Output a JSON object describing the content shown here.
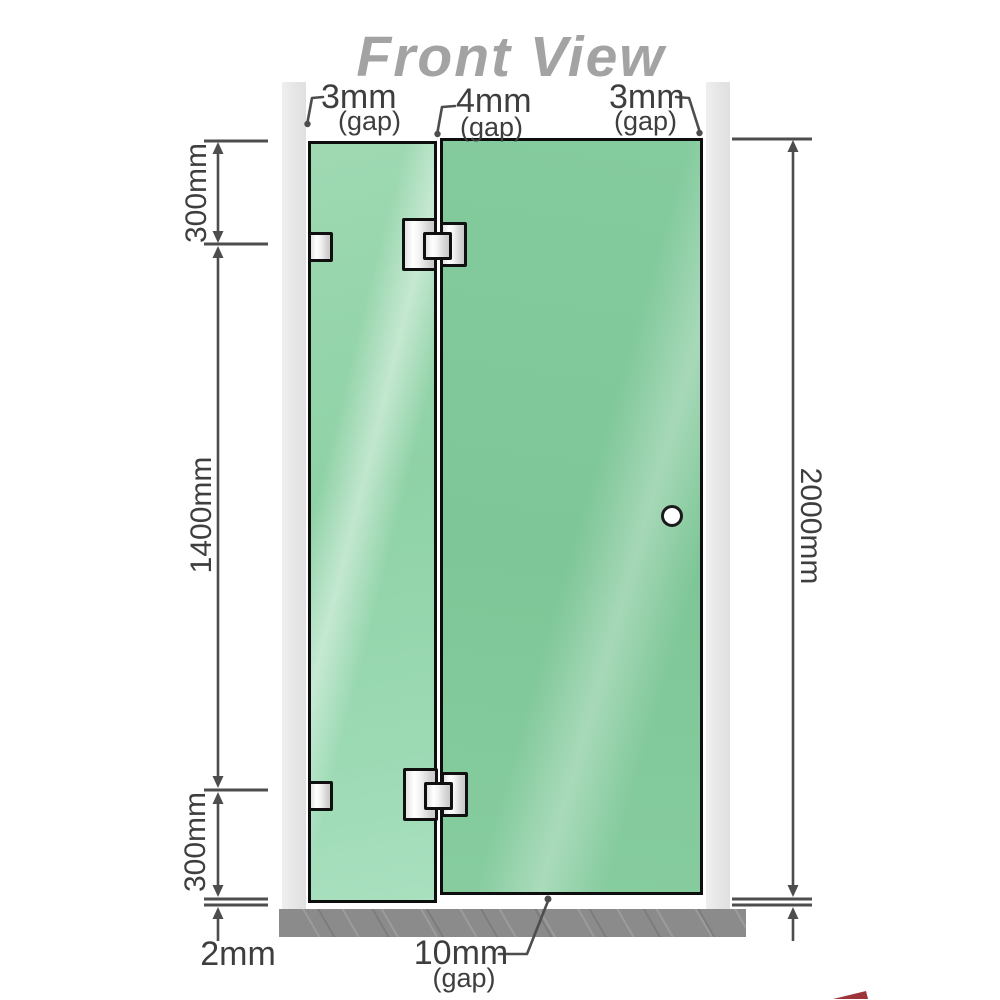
{
  "title": "Front View",
  "annotations": {
    "top_gaps": [
      {
        "value": "3mm",
        "qualifier": "(gap)"
      },
      {
        "value": "4mm",
        "qualifier": "(gap)"
      },
      {
        "value": "3mm",
        "qualifier": "(gap)"
      }
    ],
    "left_dims": {
      "top_segment": "300mm",
      "middle_segment": "1400mm",
      "bottom_segment": "300mm",
      "floor_gap": "2mm"
    },
    "right_dims": {
      "overall_height": "2000mm"
    },
    "bottom_gap": {
      "value": "10mm",
      "qualifier": "(gap)"
    }
  },
  "colors": {
    "glass_fixed_panel": "#8fd2a6",
    "glass_door_panel": "#7ec697",
    "wall_channel": "#e8e8e8",
    "floor": "#8b8b8b",
    "dimension_lines": "#4d4d4d",
    "title_text": "#a3a3a3",
    "fitting_outline": "#101010"
  }
}
